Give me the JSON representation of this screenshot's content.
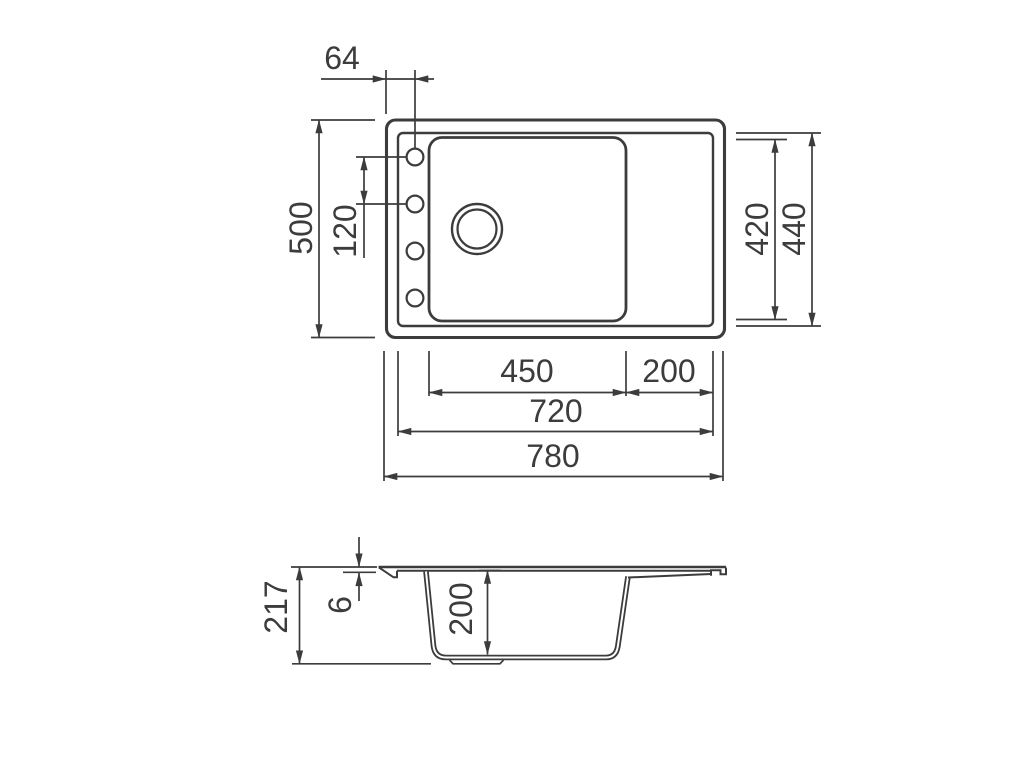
{
  "drawing": {
    "background_color": "#ffffff",
    "line_color": "#3c3c3c",
    "views": {
      "top": {
        "dims": {
          "hole_offset": "64",
          "overall_depth": "500",
          "hole_pitch": "120",
          "bowl_cutout_depth": "420",
          "basin_depth": "440",
          "bowl_width": "450",
          "drainer_width": "200",
          "basin_width": "720",
          "overall_width": "780"
        }
      },
      "section": {
        "dims": {
          "overall_height": "217",
          "rim_thickness": "6",
          "bowl_depth": "200"
        }
      }
    }
  }
}
